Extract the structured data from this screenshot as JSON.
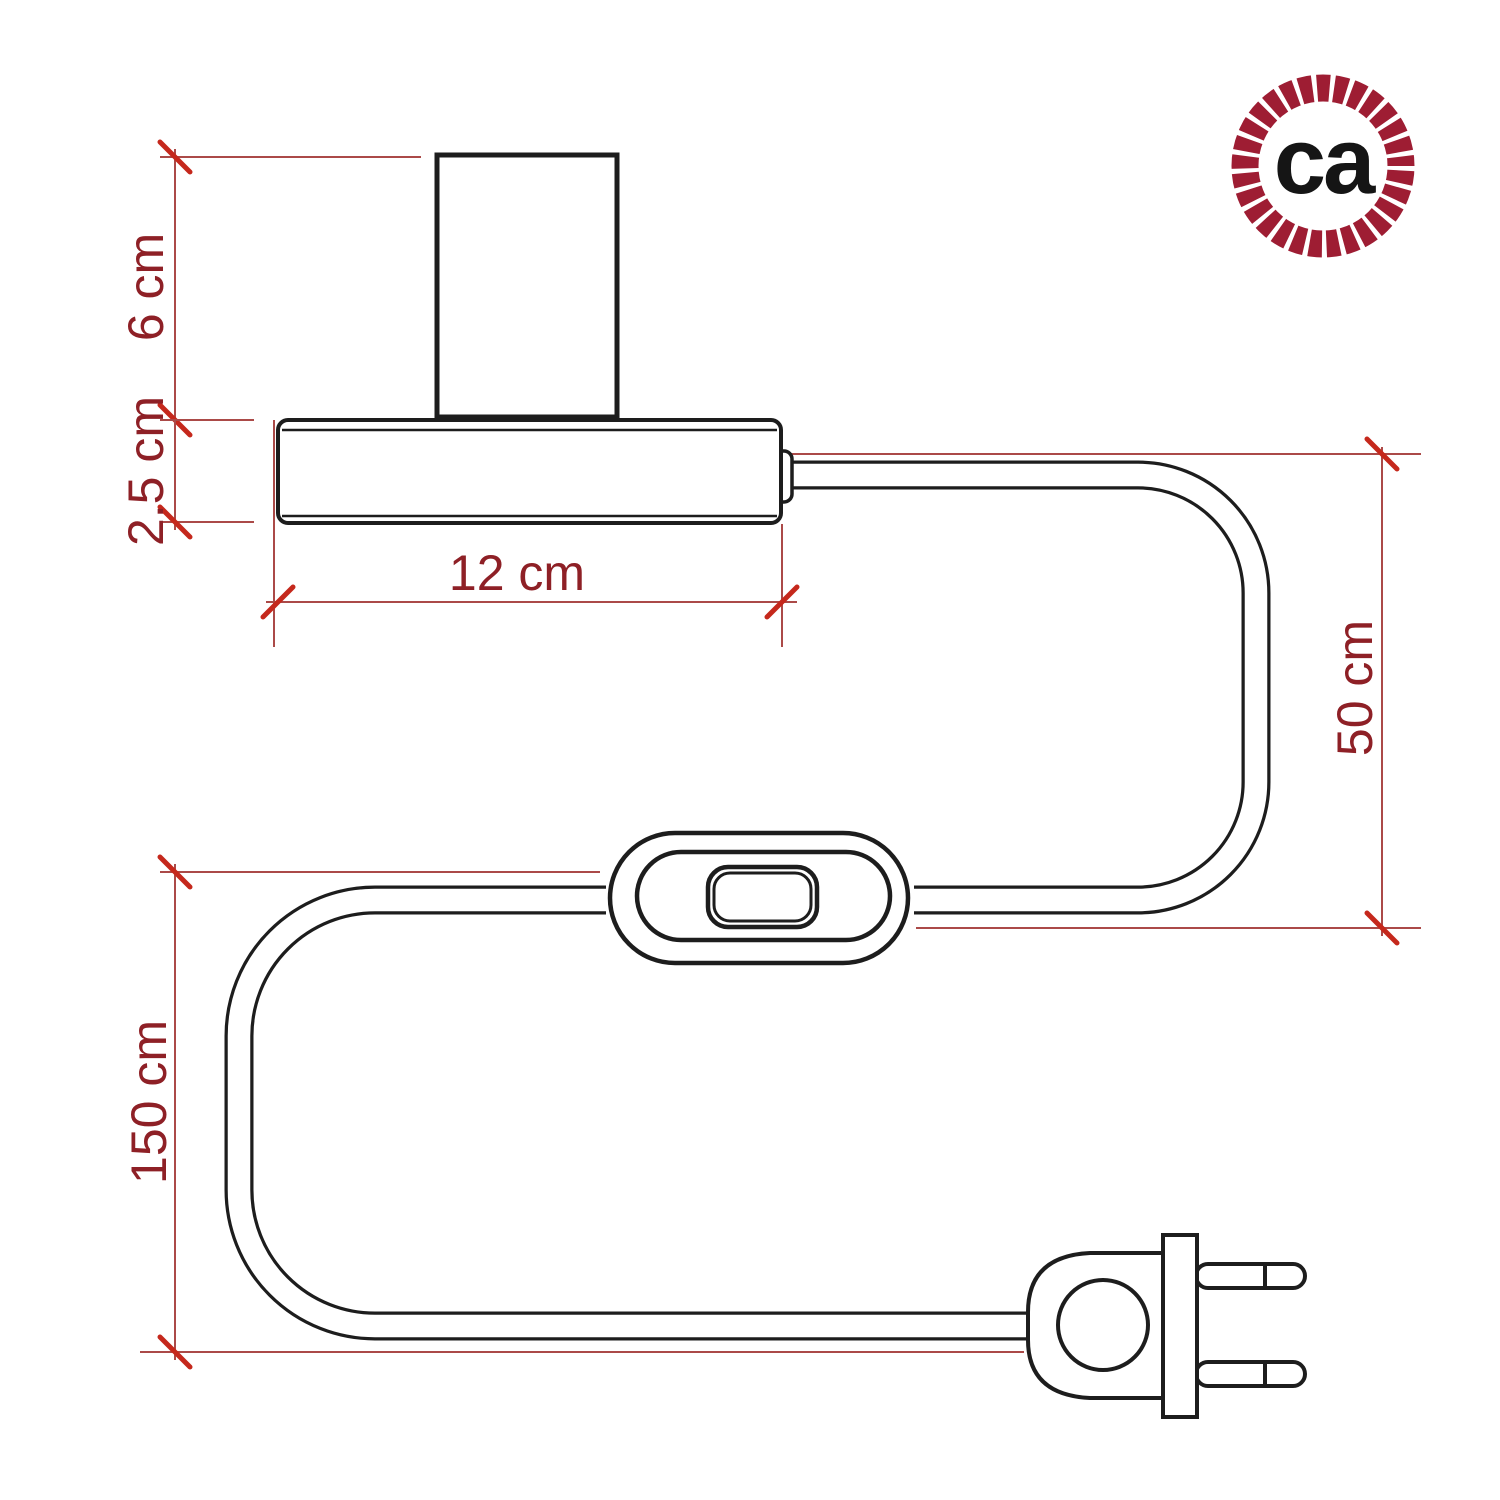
{
  "diagram": {
    "background": "#ffffff",
    "outline_color": "#1d1d1d",
    "dimension_line_color": "#ab4a48",
    "tick_color": "#c5281c",
    "label_color": "#8e2026"
  },
  "labels": {
    "holder_height": "6 cm",
    "base_height": "2.5 cm",
    "base_width": "12 cm",
    "cable_base_to_switch": "50 cm",
    "cable_total": "150 cm"
  },
  "logo": {
    "text": "ca",
    "ring_color": "#9e1d33",
    "text_color": "#151515"
  }
}
